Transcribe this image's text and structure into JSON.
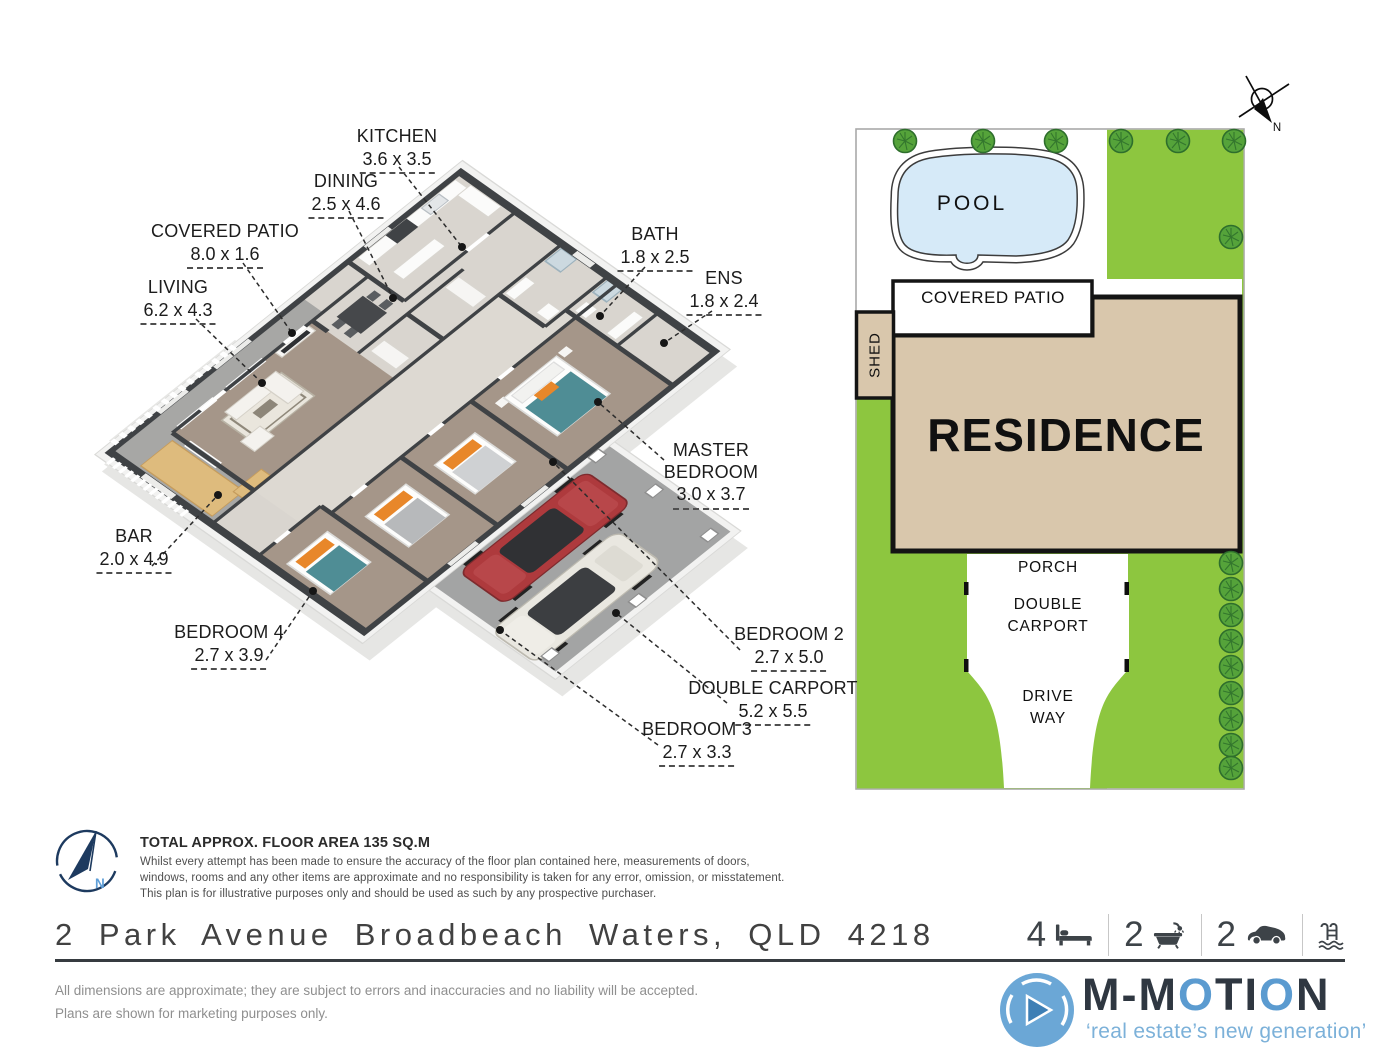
{
  "floor_plan": {
    "labels": [
      {
        "id": "kitchen",
        "name": "KITCHEN",
        "dims": "3.6 x 3.5"
      },
      {
        "id": "dining",
        "name": "DINING",
        "dims": "2.5 x 4.6"
      },
      {
        "id": "covered-patio",
        "name": "COVERED PATIO",
        "dims": "8.0 x 1.6"
      },
      {
        "id": "living",
        "name": "LIVING",
        "dims": "6.2 x 4.3"
      },
      {
        "id": "bath",
        "name": "BATH",
        "dims": "1.8 x 2.5"
      },
      {
        "id": "ens",
        "name": "ENS",
        "dims": "1.8 x 2.4"
      },
      {
        "id": "master-bedroom",
        "name": "MASTER BEDROOM",
        "dims": "3.0 x 3.7"
      },
      {
        "id": "bar",
        "name": "BAR",
        "dims": "2.0 x 4.9"
      },
      {
        "id": "bedroom-4",
        "name": "BEDROOM 4",
        "dims": "2.7 x 3.9"
      },
      {
        "id": "bedroom-2",
        "name": "BEDROOM 2",
        "dims": "2.7 x 5.0"
      },
      {
        "id": "double-carport",
        "name": "DOUBLE CARPORT",
        "dims": "5.2 x 5.5"
      },
      {
        "id": "bedroom-3",
        "name": "BEDROOM 3",
        "dims": "2.7 x 3.3"
      }
    ]
  },
  "site_plan": {
    "pool_label": "POOL",
    "covered_patio_label": "COVERED PATIO",
    "shed_label": "SHED",
    "residence_label": "RESIDENCE",
    "porch_label": "PORCH",
    "carport_label_1": "DOUBLE",
    "carport_label_2": "CARPORT",
    "driveway_label_1": "DRIVE",
    "driveway_label_2": "WAY",
    "compass_label": "N"
  },
  "area_note": {
    "title": "TOTAL APPROX. FLOOR AREA 135 SQ.M",
    "line1": "Whilst every attempt has been made to ensure the accuracy of the floor plan contained here, measurements of doors,",
    "line2": "windows, rooms and any other items are approximate and no responsibility is taken for any error, omission, or misstatement.",
    "line3": "This plan is for illustrative purposes only and should be used as such by any prospective purchaser.",
    "compass_label": "N"
  },
  "address_bar": {
    "address": "2 Park Avenue Broadbeach Waters, QLD 4218",
    "bedrooms": "4",
    "bathrooms": "2",
    "cars": "2"
  },
  "footer": {
    "disclaimer_line1": "All dimensions are approximate; they are subject to errors and inaccuracies and no liability will be accepted.",
    "disclaimer_line2": "Plans are shown for marketing purposes only.",
    "brand": {
      "part1": "M-M",
      "part2": "O",
      "part3": "TI",
      "part4": "O",
      "part5": "N"
    },
    "tagline": "‘real estate’s new generation’"
  },
  "colors": {
    "lawn": "#8dc63f",
    "pool_water": "#d6eaf8",
    "residence_fill": "#d9c7ac",
    "wall": "#3f4245",
    "carpet": "#a59689",
    "tile": "#d9d5cf",
    "patio_floor": "#a7a7a5",
    "wood_bar": "#debb7d",
    "teal_bed": "#4f8d95",
    "orange_accent": "#e8872a",
    "car_red": "#ae3a3d",
    "accent_blue": "#6ba7d6",
    "navy": "#1d3a5f"
  }
}
